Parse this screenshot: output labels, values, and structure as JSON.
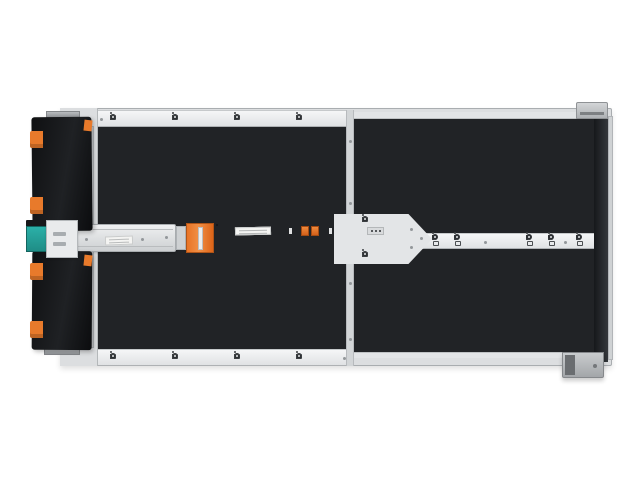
{
  "figure": {
    "type": "product-photo",
    "subject": "Top view of a high-density JBOD storage enclosure with rows of hot-swap drive bays and orange release latches",
    "background_color": "#ffffff"
  },
  "colors": {
    "latch_orange": "#e06a1f",
    "latch_orange_highlight": "#f9a359",
    "latch_orange_dark": "#a84a10",
    "accent_orange": "#e87a2b",
    "bay_window_black": "#0a0b0d",
    "chassis_light": "#dcdee0",
    "backplate_dark": "#212326",
    "cable_connector_teal": "#28a89f",
    "label_white": "#f4f4f2"
  },
  "enclosure": {
    "drive_sections": [
      {
        "id": "left-top",
        "columns": 4,
        "rows": 6
      },
      {
        "id": "left-bottom",
        "columns": 4,
        "rows": 6
      },
      {
        "id": "right-top",
        "columns": 4,
        "rows": 7
      },
      {
        "id": "right-bottom",
        "columns": 4,
        "rows": 7
      }
    ],
    "visible_drive_bays": 104,
    "center_module": {
      "ssd_trays": 2,
      "orange_clips_per_tray": 2
    },
    "top_rail_latch_icon_clusters": 4,
    "bottom_rail_latch_icon_clusters": 4,
    "right_rail_lock_icon_pairs": 3,
    "cable_arm_orange_clips": 4
  },
  "icons": {
    "latch_indicator_cluster": "i + filled-circle + open-square",
    "lock_indicator": "circle-dot over square",
    "screw": "dot"
  }
}
